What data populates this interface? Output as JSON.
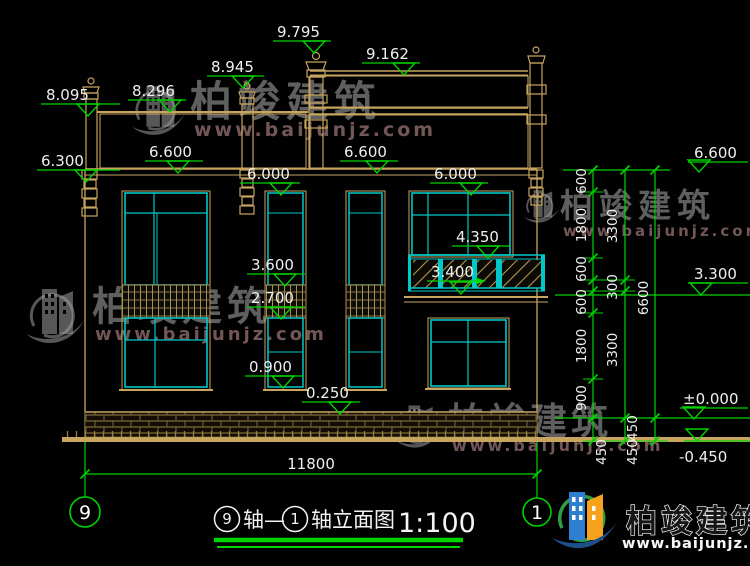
{
  "colors": {
    "cad_green": "#00d400",
    "cad_cyan": "#00c8c8",
    "cad_tan": "#c8a55f",
    "text_white": "#efefef",
    "watermark_gray": "#9e9e9e",
    "logo_blue": "#2e7fd0",
    "logo_orange": "#f6a21d",
    "logo_green": "#2f9e44",
    "logo_swoosh": "#1d4f8a"
  },
  "levels": [
    "8.095",
    "8.296",
    "8.945",
    "9.795",
    "9.162",
    "6.300",
    "6.600",
    "6.600",
    "6.000",
    "6.000",
    "4.350",
    "3.600",
    "2.700",
    "0.900",
    "0.250",
    "3.400",
    "6.600",
    "3.300",
    "±0.000",
    "-0.450"
  ],
  "dims": {
    "overall_width": "11800",
    "chain_inner": [
      "600",
      "1800",
      "600",
      "600",
      "1800",
      "900"
    ],
    "chain_small": "300",
    "chain_mid": [
      "3300",
      "3300"
    ],
    "chain_total": "6600",
    "below_datum": [
      "450",
      "450",
      "450"
    ]
  },
  "axis_bubbles": {
    "left": "9",
    "right": "1"
  },
  "title": {
    "left_axis": "9",
    "mid": "轴—",
    "right_axis": "1",
    "name": "轴立面图",
    "scale": "1:100"
  },
  "watermark": {
    "brand": "柏竣建筑",
    "url": "www.baijunjz.com"
  },
  "footer_logo": {
    "brand": "柏竣建筑",
    "url": "www.baijunjz.com"
  }
}
